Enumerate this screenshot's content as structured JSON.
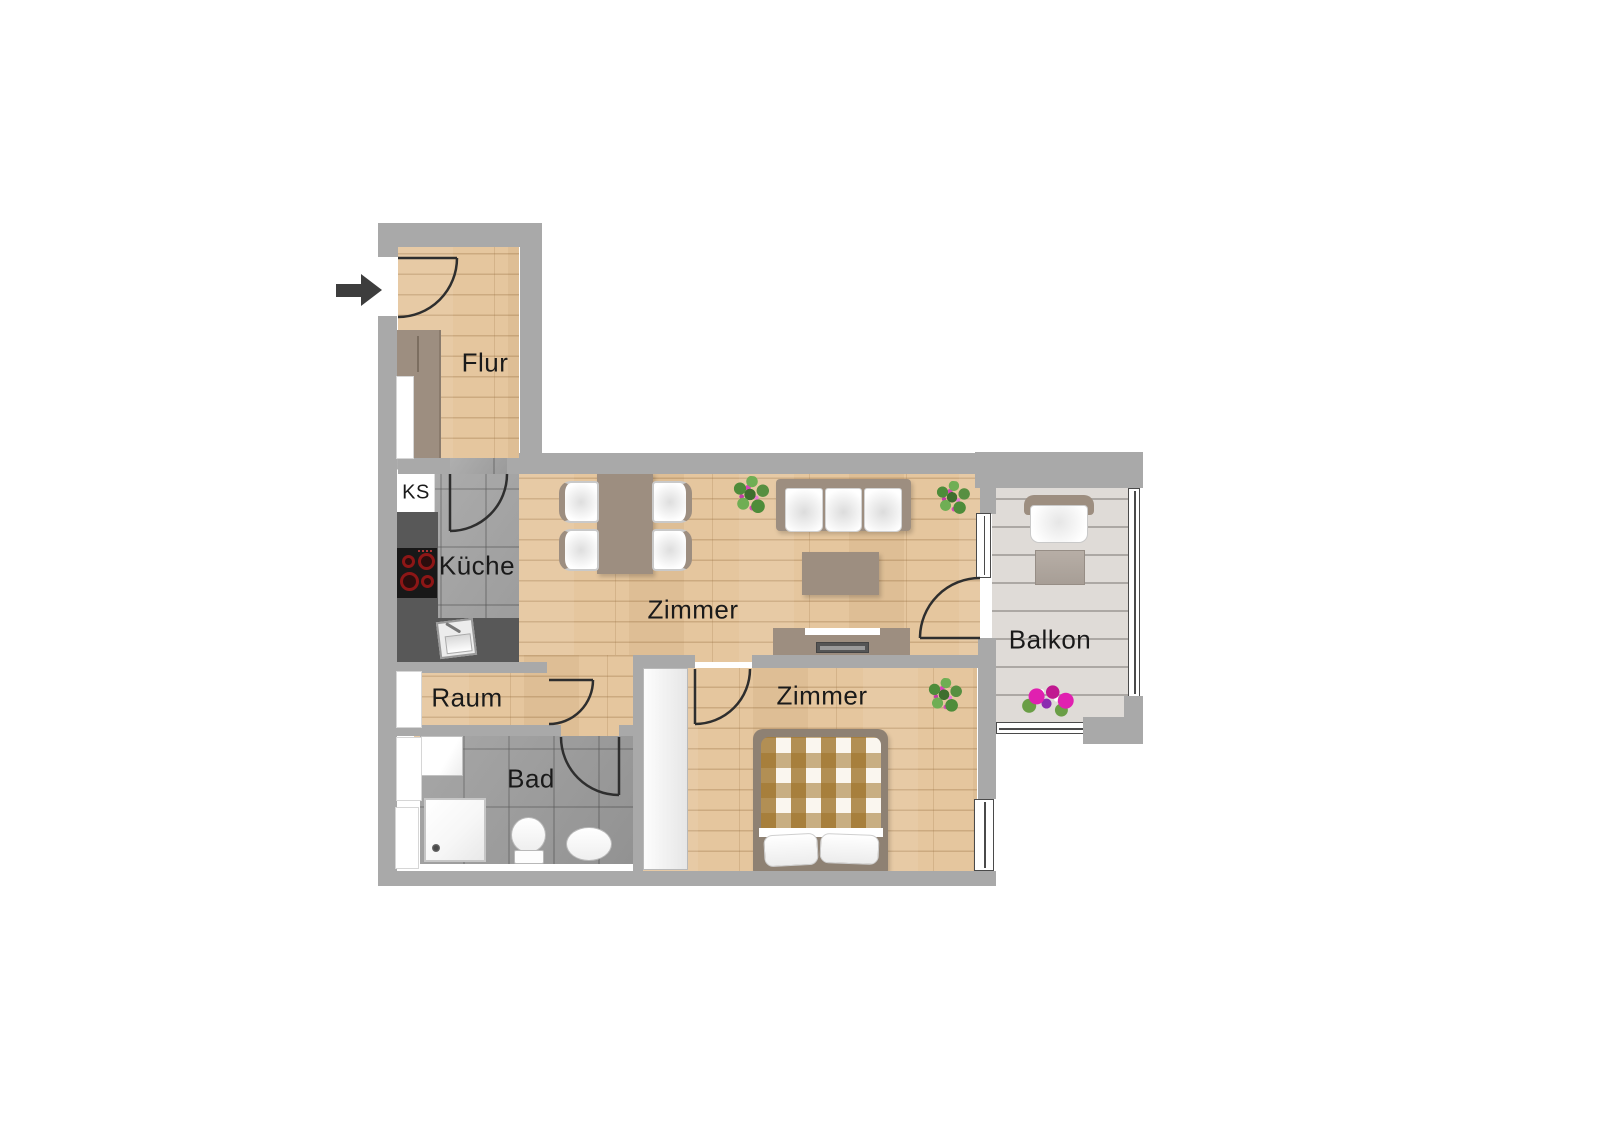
{
  "entrance": {
    "arrow_direction": "right"
  },
  "rooms": {
    "flur": {
      "label": "Flur"
    },
    "kueche": {
      "label": "Küche"
    },
    "kuehlschrank": {
      "label": "KS"
    },
    "living": {
      "label": "Zimmer"
    },
    "bedroom": {
      "label": "Zimmer"
    },
    "raum": {
      "label": "Raum"
    },
    "bad": {
      "label": "Bad"
    },
    "balkon": {
      "label": "Balkon"
    }
  },
  "colors": {
    "wall": "#a9a9a9",
    "wood_floor": "#e5c69e",
    "tile_floor": "#a6a6a6",
    "balcony_floor": "#dfdbd7",
    "furniture_taupe": "#9d8e80",
    "kitchen_counter": "#585858",
    "flower_pink": "#d936b3",
    "label_text": "#1a1a1a"
  },
  "furniture_icons": [
    "entry-arrow-icon",
    "wardrobe-icon",
    "fridge-icon",
    "cooktop-icon",
    "kitchen-sink-icon",
    "dining-table-icon",
    "chair-icon",
    "sofa-icon",
    "coffee-table-icon",
    "tv-lowboard-icon",
    "plant-icon",
    "washing-machine-icon",
    "shower-icon",
    "toilet-icon",
    "washbasin-icon",
    "closet-icon",
    "double-bed-icon",
    "balcony-chair-icon",
    "balcony-table-icon",
    "flower-box-icon"
  ]
}
